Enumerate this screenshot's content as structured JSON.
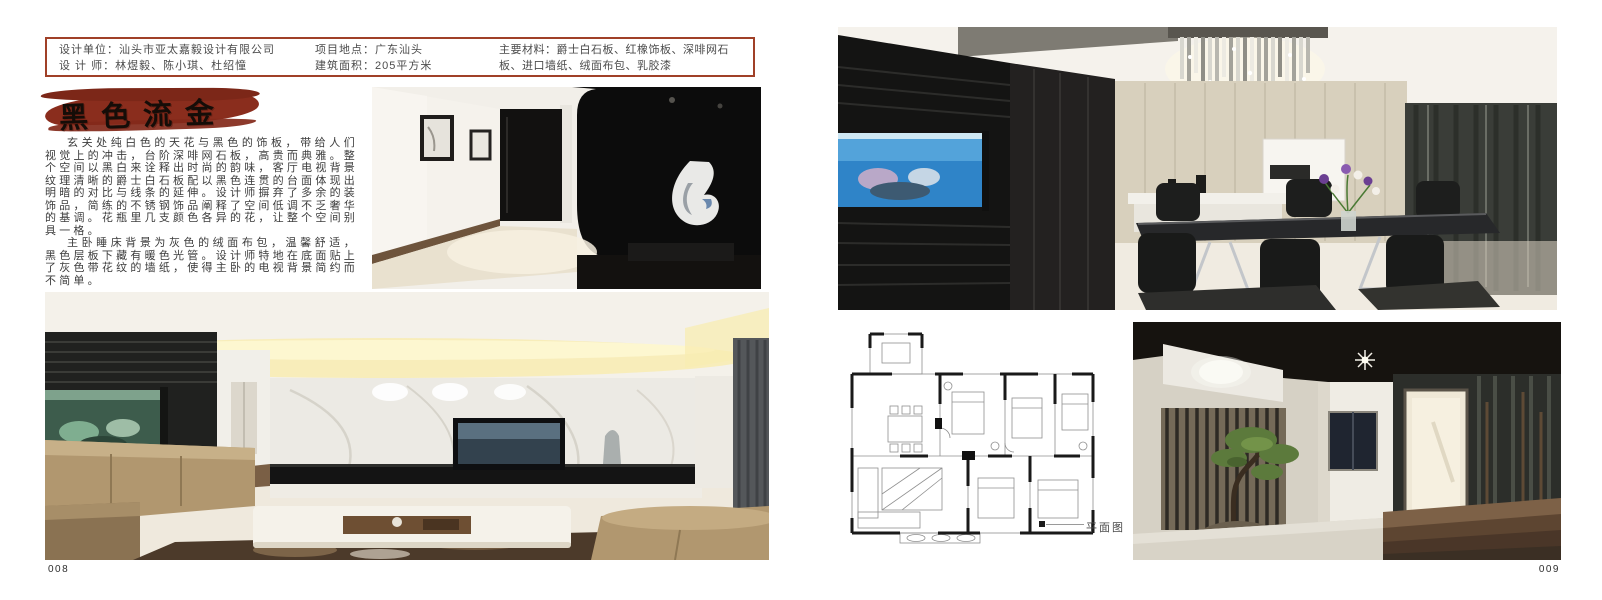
{
  "left_page": {
    "info_box": {
      "design_unit": "设计单位：汕头市亚太嘉毅设计有限公司",
      "designers": "设 计 师：林煜毅、陈小琪、杜绍憧",
      "location": "项目地点：广东汕头",
      "area": "建筑面积：205平方米",
      "materials": "主要材料：爵士白石板、红橡饰板、深啡网石板、进口墙纸、绒面布包、乳胶漆"
    },
    "title": "黑色流金",
    "paragraph1": "玄关处纯白色的天花与黑色的饰板，带给人们视觉上的冲击，台阶深啡网石板，高贵而典雅。整个空间以黑白来诠释出时尚的韵味，客厅电视背景纹理清晰的爵士白石板配以黑色连贯的台面体现出明暗的对比与线条的延伸。设计师摒弃了多余的装饰品，简练的不锈钢饰品阐释了空间低调不乏奢华的基调。花瓶里几支颜色各异的花，让整个空间别具一格。",
    "paragraph2": "主卧睡床背景为灰色的绒面布包，温馨舒适，黑色层板下藏有暖色光管。设计师特地在底面贴上了灰色带花纹的墙纸，使得主卧的电视背景简约而不简单。",
    "page_number": "008"
  },
  "right_page": {
    "floorplan_caption": "平面图",
    "page_number": "009"
  },
  "colors": {
    "info_box_border": "#a04028",
    "brush_red": "#8a2d1d",
    "body_text": "#3c3c3c"
  }
}
